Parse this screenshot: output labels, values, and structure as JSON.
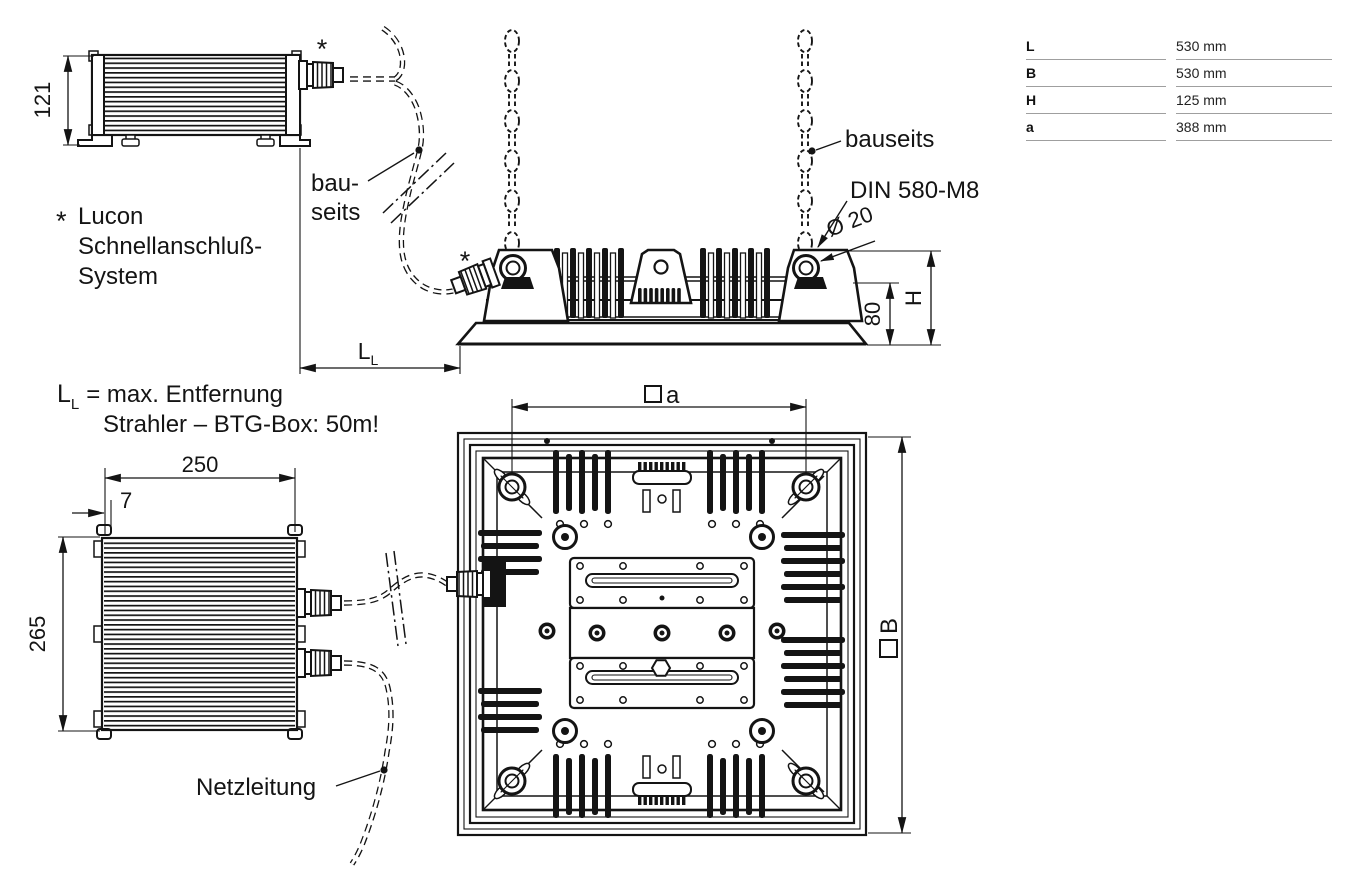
{
  "drawing": {
    "btg_box_side": {
      "dim_height": "121",
      "connector_mark": "*"
    },
    "lucon_note": {
      "star": "*",
      "line1": "Lucon",
      "line2": "Schnellanschluß-",
      "line3": "System"
    },
    "cable_note_left": {
      "line1": "bau-",
      "line2": "seits"
    },
    "floodlight_side": {
      "chain_label": "bauseits",
      "eyebolt_label": "DIN 580-M8",
      "eyebolt_diameter": "Ø 20",
      "dim_inner_height": "80",
      "dim_total_height": "H",
      "connector_mark": "*"
    },
    "distance_dim": {
      "symbol_main": "L",
      "symbol_sub": "L"
    },
    "distance_note": {
      "symbol_main": "L",
      "symbol_sub": "L",
      "text": "= max. Entfernung",
      "line2": "Strahler – BTG-Box: 50m!"
    },
    "btg_box_top": {
      "dim_width": "250",
      "dim_offset": "7",
      "dim_height": "265",
      "cable_label": "Netzleitung"
    },
    "floodlight_top": {
      "dim_hole_letter": "a",
      "dim_width_letter": "B"
    }
  },
  "table": {
    "rows": [
      {
        "label": "L",
        "value": "530 mm"
      },
      {
        "label": "B",
        "value": "530 mm"
      },
      {
        "label": "H",
        "value": "125 mm"
      },
      {
        "label": "a",
        "value": "388 mm"
      }
    ]
  }
}
